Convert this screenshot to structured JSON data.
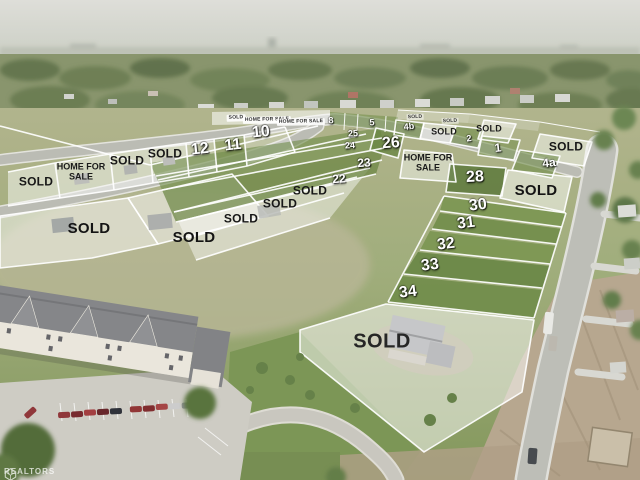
{
  "watermark": {
    "brand": "REALTORS",
    "icon": "cube-logo-icon"
  },
  "labels": [
    {
      "id": "banner-sold-1",
      "text": "SOLD",
      "x": 236,
      "y": 118,
      "kind": "banner",
      "rot": -2
    },
    {
      "id": "banner-home-for-sale-1",
      "text": "HOME FOR SALE",
      "x": 267,
      "y": 120,
      "kind": "banner",
      "rot": -1
    },
    {
      "id": "banner-home-for-sale-2",
      "text": "HOME FOR SALE",
      "x": 301,
      "y": 122,
      "kind": "banner",
      "rot": -1
    },
    {
      "id": "lot-8",
      "text": "8",
      "x": 331,
      "y": 121,
      "kind": "num-sm",
      "rot": -3
    },
    {
      "id": "lot-5",
      "text": "5",
      "x": 372,
      "y": 123,
      "kind": "num-sm",
      "rot": -3
    },
    {
      "id": "banner-sold-2",
      "text": "SOLD",
      "x": 415,
      "y": 117,
      "kind": "banner-plain",
      "rot": -2
    },
    {
      "id": "lot-4b",
      "text": "4b",
      "x": 409,
      "y": 127,
      "kind": "num-sm",
      "rot": -6
    },
    {
      "id": "banner-sold-3",
      "text": "SOLD",
      "x": 450,
      "y": 121,
      "kind": "banner-plain",
      "rot": -2
    },
    {
      "id": "sold-lot-a",
      "text": "SOLD",
      "x": 444,
      "y": 132,
      "kind": "sold-sm",
      "rot": 0
    },
    {
      "id": "sold-lot-b",
      "text": "SOLD",
      "x": 489,
      "y": 129,
      "kind": "sold-sm",
      "rot": 0
    },
    {
      "id": "lot-2",
      "text": "2",
      "x": 469,
      "y": 139,
      "kind": "num-sm",
      "rot": -6
    },
    {
      "id": "lot-1",
      "text": "1",
      "x": 498,
      "y": 148,
      "kind": "num-md",
      "rot": -6
    },
    {
      "id": "sold-lot-c",
      "text": "SOLD",
      "x": 566,
      "y": 147,
      "kind": "sold-md",
      "rot": 0
    },
    {
      "id": "lot-4a",
      "text": "4a",
      "x": 549,
      "y": 163,
      "kind": "num-md",
      "rot": -6
    },
    {
      "id": "lot-25",
      "text": "25",
      "x": 353,
      "y": 134,
      "kind": "num-sm",
      "rot": -3
    },
    {
      "id": "lot-24",
      "text": "24",
      "x": 350,
      "y": 146,
      "kind": "num-sm",
      "rot": -3
    },
    {
      "id": "lot-26",
      "text": "26",
      "x": 391,
      "y": 144,
      "kind": "num-lg",
      "rot": -4
    },
    {
      "id": "home-for-sale-right",
      "text": "HOME FOR\nSALE",
      "x": 428,
      "y": 163,
      "kind": "home2",
      "rot": 0
    },
    {
      "id": "lot-23",
      "text": "23",
      "x": 364,
      "y": 163,
      "kind": "num-md",
      "rot": -4
    },
    {
      "id": "lot-22",
      "text": "22",
      "x": 339,
      "y": 179,
      "kind": "num-md",
      "rot": -4
    },
    {
      "id": "lot-28",
      "text": "28",
      "x": 475,
      "y": 178,
      "kind": "num-lg",
      "rot": -3
    },
    {
      "id": "sold-lot-d",
      "text": "SOLD",
      "x": 536,
      "y": 191,
      "kind": "sold-lg",
      "rot": 0
    },
    {
      "id": "lot-12",
      "text": "12",
      "x": 200,
      "y": 150,
      "kind": "num-lg",
      "rot": -6
    },
    {
      "id": "lot-11",
      "text": "11",
      "x": 233,
      "y": 146,
      "kind": "num-lg",
      "rot": -6
    },
    {
      "id": "lot-10",
      "text": "10",
      "x": 261,
      "y": 133,
      "kind": "num-lg",
      "rot": -6
    },
    {
      "id": "sold-lot-e",
      "text": "SOLD",
      "x": 165,
      "y": 154,
      "kind": "sold-md",
      "rot": 0
    },
    {
      "id": "sold-lot-f",
      "text": "SOLD",
      "x": 127,
      "y": 161,
      "kind": "sold-md",
      "rot": 0
    },
    {
      "id": "home-for-sale-left",
      "text": "HOME FOR\nSALE",
      "x": 81,
      "y": 172,
      "kind": "home2",
      "rot": 0
    },
    {
      "id": "sold-lot-g",
      "text": "SOLD",
      "x": 36,
      "y": 182,
      "kind": "sold-md",
      "rot": 0
    },
    {
      "id": "sold-lot-h",
      "text": "SOLD",
      "x": 310,
      "y": 191,
      "kind": "sold-md",
      "rot": 0
    },
    {
      "id": "sold-lot-i",
      "text": "SOLD",
      "x": 280,
      "y": 204,
      "kind": "sold-md",
      "rot": 0
    },
    {
      "id": "sold-lot-j",
      "text": "SOLD",
      "x": 241,
      "y": 219,
      "kind": "sold-md",
      "rot": 0
    },
    {
      "id": "sold-lot-k",
      "text": "SOLD",
      "x": 89,
      "y": 229,
      "kind": "sold-lg",
      "rot": 0
    },
    {
      "id": "sold-lot-l",
      "text": "SOLD",
      "x": 194,
      "y": 238,
      "kind": "sold-lg",
      "rot": 0
    },
    {
      "id": "lot-30",
      "text": "30",
      "x": 478,
      "y": 206,
      "kind": "num-lg",
      "rot": -7
    },
    {
      "id": "lot-31",
      "text": "31",
      "x": 466,
      "y": 224,
      "kind": "num-lg",
      "rot": -7
    },
    {
      "id": "lot-32",
      "text": "32",
      "x": 446,
      "y": 245,
      "kind": "num-lg",
      "rot": -7
    },
    {
      "id": "lot-33",
      "text": "33",
      "x": 430,
      "y": 266,
      "kind": "num-lg",
      "rot": -7
    },
    {
      "id": "lot-34",
      "text": "34",
      "x": 408,
      "y": 293,
      "kind": "num-lg",
      "rot": -7
    },
    {
      "id": "sold-lot-m",
      "text": "SOLD",
      "x": 382,
      "y": 342,
      "kind": "sold-xl",
      "rot": 0
    }
  ],
  "colors": {
    "grass_dark": "#5d7c35",
    "grass_bright": "#6f8c44",
    "field": "#a9ac84",
    "street": "#b7b8b0",
    "sold_overlay": "rgba(255,255,255,0.48)",
    "dirt": "#b3a289"
  }
}
